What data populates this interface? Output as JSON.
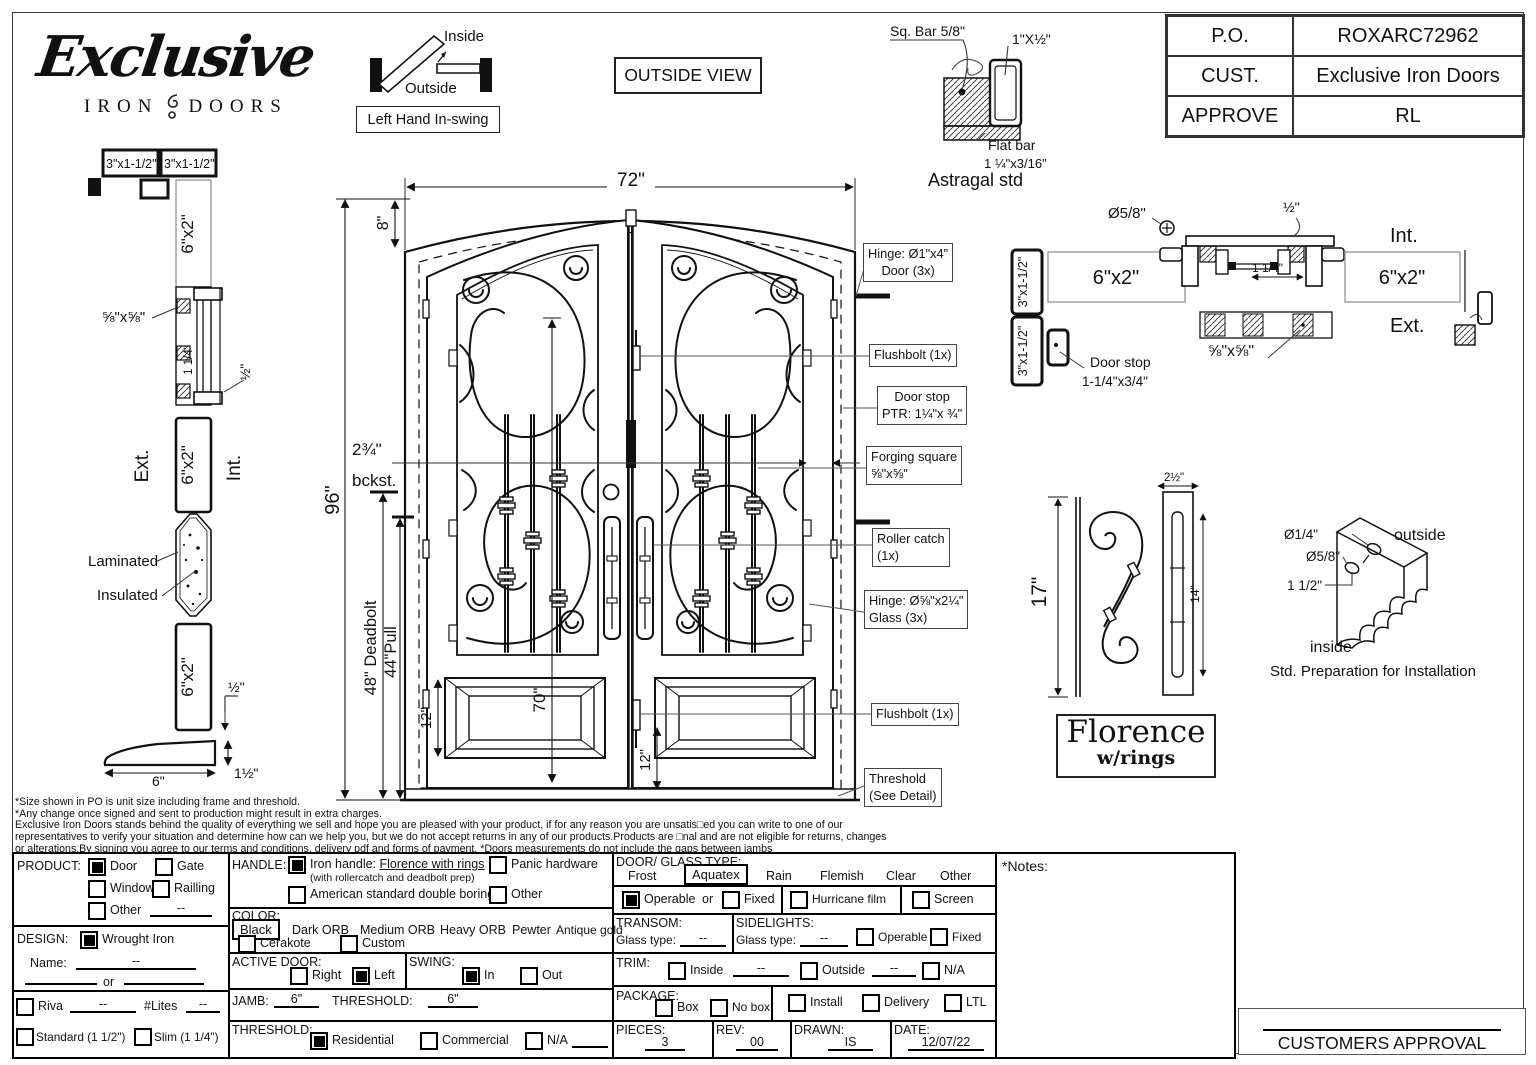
{
  "sheet": {
    "logo": {
      "script": "Exclusive",
      "iron": "IRON",
      "doors": "DOORS"
    },
    "swing": {
      "inside": "Inside",
      "outside": "Outside",
      "caption": "Left Hand In-swing"
    },
    "view_label": "OUTSIDE VIEW",
    "po_table": {
      "r1l": "P.O.",
      "r1v": "ROXARC72962",
      "r2l": "CUST.",
      "r2v": "Exclusive Iron Doors",
      "r3l": "APPROVE",
      "r3v": "RL"
    }
  },
  "astragal": {
    "sq_bar": "Sq. Bar 5/8\"",
    "tube": "1\"X½\"",
    "flat": "Flat bar",
    "flat_size": "1 ¼\"x3/16\"",
    "caption": "Astragal std"
  },
  "left_section": {
    "box1": "3\"x1-1/2\"",
    "box2": "3\"x1-1/2\"",
    "tube_top": "6\"x2\"",
    "bar": "⅝\"x⅝\"",
    "dim114": "1 1/4\"",
    "dim_half": "½\"",
    "ext": "Ext.",
    "int": "Int.",
    "tube_mid": "6\"x2\"",
    "laminated": "Laminated",
    "insulated": "Insulated",
    "tube_bot": "6\"x2\"",
    "half2": "½\"",
    "six": "6\"",
    "one_half": "1½\""
  },
  "elevation": {
    "w": "72\"",
    "arch": "8\"",
    "h": "96\"",
    "deadbolt": "48\" Deadbolt",
    "pull": "44\"Pull",
    "backset": "2¾\"",
    "bckst": "bckst.",
    "glass": "70\"",
    "panel": "12\"",
    "flush": "12\""
  },
  "callouts": {
    "hinge1a": "Hinge: Ø1\"x4\"",
    "hinge1b": "Door (3x)",
    "flush_top": "Flushbolt (1x)",
    "stop1": "Door stop",
    "stop2": "PTR: 1¼\"x ¾\"",
    "forge1": "Forging square",
    "forge2": "⅝\"x⅝\"",
    "roller1": "Roller catch",
    "roller2": "(1x)",
    "hinge2a": "Hinge: Ø⅝\"x2¼\"",
    "hinge2b": "Glass (3x)",
    "flush_bot": "Flushbolt (1x)",
    "thr1": "Threshold",
    "thr2": "(See Detail)"
  },
  "head_section": {
    "b1": "3\"x1-1/2\"",
    "b2": "3\"x1-1/2\"",
    "tube_l": "6\"x2\"",
    "dia": "Ø5/8\"",
    "half": "½\"",
    "dim114": "1 1/4\"",
    "bar": "⅝\"x⅝\"",
    "int": "Int.",
    "ext": "Ext.",
    "tube_r": "6\"x2\"",
    "stop1": "Door stop",
    "stop2": "1-1/4\"x3/4\""
  },
  "handle": {
    "h": "17\"",
    "w": "2½\"",
    "slot": "14\"",
    "name": "Florence",
    "sub": "w/rings"
  },
  "prep": {
    "d1": "Ø1/4\"",
    "d2": "Ø5/8\"",
    "d3": "1 1/2\"",
    "outside": "outside",
    "inside": "inside",
    "caption": "Std. Preparation for Installation"
  },
  "disclaimer": {
    "l1": "*Size shown in PO is unit size including frame and threshold.",
    "l2": "*Any change once signed and sent to production might result in extra charges.",
    "l3": "Exclusive Iron Doors stands behind the quality of everything we sell and hope you are pleased with your product, if for any reason you are unsatis□ed you can write to one of our",
    "l4": "representatives to verify your situation and determine how can we help you, but we do not accept returns in any of our products.Products are □nal and are not eligible for returns, changes",
    "l5": "or alterations.By signing you agree to our terms and conditions, delivery pdf and forms of payment. *Doors measurements do not include the gaps between jambs"
  },
  "form": {
    "product": {
      "label": "PRODUCT:",
      "door": "Door",
      "gate": "Gate",
      "window": "Window",
      "railing": "Railling",
      "other": "Other",
      "other_val": "--"
    },
    "design": {
      "label": "DESIGN:",
      "wrought": "Wrought Iron",
      "name": "Name:",
      "name_val": "--",
      "or": "or"
    },
    "riva": {
      "riva": "Riva",
      "riva_val": "--",
      "lites": "#Lites",
      "lites_val": "--",
      "standard": "Standard (1 1/2\")",
      "slim": "Slim (1 1/4\")"
    },
    "handle": {
      "label": "HANDLE:",
      "iron": "Iron handle: ",
      "iron_u": "Florence with rings",
      "iron_sub": "(with rollercatch and deadbolt prep)",
      "american": "American standard double boring",
      "panic": "Panic hardware",
      "other": "Other"
    },
    "color": {
      "label": "COLOR:",
      "black": "Black",
      "dark": "Dark ORB",
      "medium": "Medium ORB",
      "heavy": "Heavy ORB",
      "pewter": "Pewter",
      "antique": "Antique gold",
      "cerakote": "Cerakote",
      "custom": "Custom"
    },
    "active": {
      "label": "ACTIVE DOOR:",
      "right": "Right",
      "left": "Left"
    },
    "swing": {
      "label": "SWING:",
      "in": "In",
      "out": "Out"
    },
    "jamb": {
      "label": "JAMB:",
      "val": "6\"",
      "thr_label": "THRESHOLD:",
      "thr_val": "6\""
    },
    "threshold": {
      "label": "THRESHOLD:",
      "res": "Residential",
      "com": "Commercial",
      "na": "N/A"
    },
    "glass": {
      "label": "DOOR/ GLASS TYPE:",
      "frost": "Frost",
      "aquatex": "Aquatex",
      "rain": "Rain",
      "flemish": "Flemish",
      "clear": "Clear",
      "other": "Other",
      "operable": "Operable",
      "or": "or",
      "fixed": "Fixed",
      "hurricane": "Hurricane film",
      "screen": "Screen"
    },
    "transom": {
      "label": "TRANSOM:",
      "glass_type": "Glass type:",
      "val": "--"
    },
    "sidelights": {
      "label": "SIDELIGHTS:",
      "glass_type": "Glass type:",
      "val": "--",
      "operable": "Operable",
      "fixed": "Fixed"
    },
    "trim": {
      "label": "TRIM:",
      "inside": "Inside",
      "inside_val": "--",
      "outside": "Outside",
      "outside_val": "--",
      "na": "N/A"
    },
    "package": {
      "label": "PACKAGE:",
      "box": "Box",
      "nobox": "No box",
      "install": "Install",
      "delivery": "Delivery",
      "ltl": "LTL"
    },
    "meta": {
      "pieces_label": "PIECES:",
      "pieces": "3",
      "rev_label": "REV:",
      "rev": "00",
      "drawn_label": "DRAWN:",
      "drawn": "IS",
      "date_label": "DATE:",
      "date": "12/07/22"
    },
    "notes_label": "*Notes:"
  },
  "approval": "CUSTOMERS APPROVAL"
}
